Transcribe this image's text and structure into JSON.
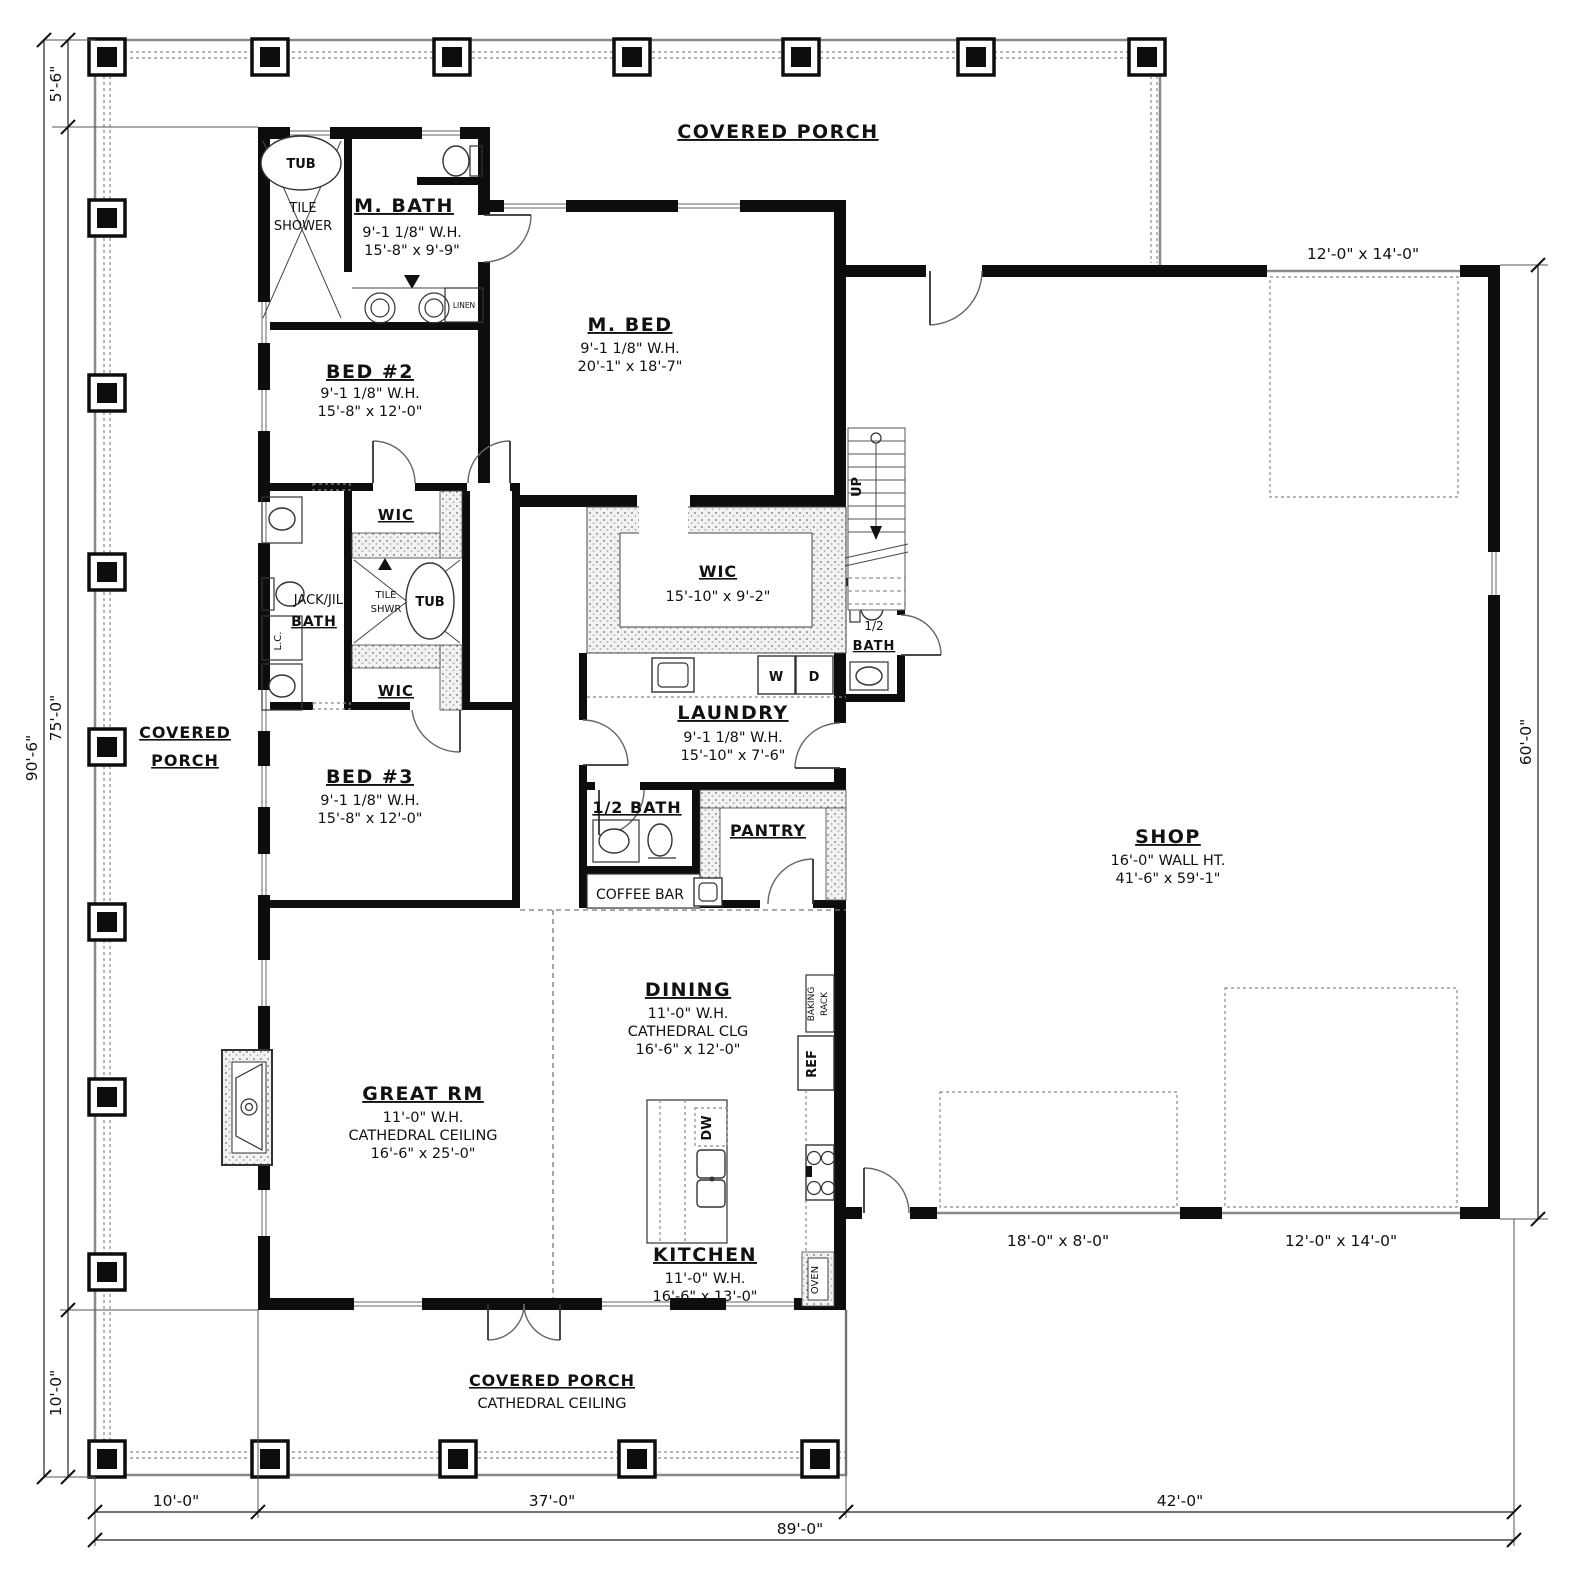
{
  "porch": {
    "top": "COVERED PORCH",
    "left1": "COVERED",
    "left2": "PORCH",
    "bottom": "COVERED PORCH",
    "bottom_sub": "CATHEDRAL CEILING"
  },
  "rooms": {
    "m_bath": {
      "name": "M. BATH",
      "wh": "9'-1 1/8\" W.H.",
      "size": "15'-8\" x 9'-9\""
    },
    "m_bed": {
      "name": "M. BED",
      "wh": "9'-1 1/8\" W.H.",
      "size": "20'-1\" x 18'-7\""
    },
    "bed2": {
      "name": "BED #2",
      "wh": "9'-1 1/8\" W.H.",
      "size": "15'-8\" x 12'-0\""
    },
    "bed3": {
      "name": "BED #3",
      "wh": "9'-1 1/8\" W.H.",
      "size": "15'-8\" x 12'-0\""
    },
    "jack_jill": {
      "line1": "JACK/JILL",
      "line2": "BATH"
    },
    "wic_top": {
      "name": "WIC"
    },
    "wic_bottom": {
      "name": "WIC"
    },
    "wic_master": {
      "name": "WIC",
      "size": "15'-10\" x 9'-2\""
    },
    "laundry": {
      "name": "LAUNDRY",
      "wh": "9'-1 1/8\" W.H.",
      "size": "15'-10\" x 7'-6\""
    },
    "half_bath_shop": {
      "line1": "1/2",
      "line2": "BATH"
    },
    "half_bath": {
      "name": "1/2 BATH"
    },
    "pantry": {
      "name": "PANTRY"
    },
    "coffee_bar": {
      "name": "COFFEE BAR"
    },
    "dining": {
      "name": "DINING",
      "wh": "11'-0\" W.H.",
      "clg": "CATHEDRAL CLG",
      "size": "16'-6\" x 12'-0\""
    },
    "kitchen": {
      "name": "KITCHEN",
      "wh": "11'-0\" W.H.",
      "size": "16'-6\" x 13'-0\""
    },
    "great_rm": {
      "name": "GREAT RM",
      "wh": "11'-0\" W.H.",
      "clg": "CATHEDRAL CEILING",
      "size": "16'-6\" x 25'-0\""
    },
    "shop": {
      "name": "SHOP",
      "wall": "16'-0\" WALL HT.",
      "size": "41'-6\" x 59'-1\""
    }
  },
  "fixtures": {
    "tub": "TUB",
    "tile1": "TILE",
    "tile2": "SHOWER",
    "tile_shwr1": "TILE",
    "tile_shwr2": "SHWR",
    "tub2": "TUB",
    "linen": "LINEN",
    "lc": "L.C.",
    "washer": "W",
    "dryer": "D",
    "up": "UP",
    "dw": "DW",
    "ref": "REF",
    "oven": "OVEN",
    "baking1": "BAKING",
    "baking2": "RACK"
  },
  "dims": {
    "left_total": "90'-6\"",
    "left_top": "5'-6\"",
    "left_main": "75'-0\"",
    "left_bottom": "10'-0\"",
    "bottom_porch": "10'-0\"",
    "bottom_house": "37'-0\"",
    "bottom_shop": "42'-0\"",
    "bottom_total": "89'-0\"",
    "right_shop": "60'-0\"",
    "oh_top": "12'-0\" x 14'-0\"",
    "oh_bottom_left": "18'-0\" x 8'-0\"",
    "oh_bottom_right": "12'-0\" x 14'-0\""
  }
}
